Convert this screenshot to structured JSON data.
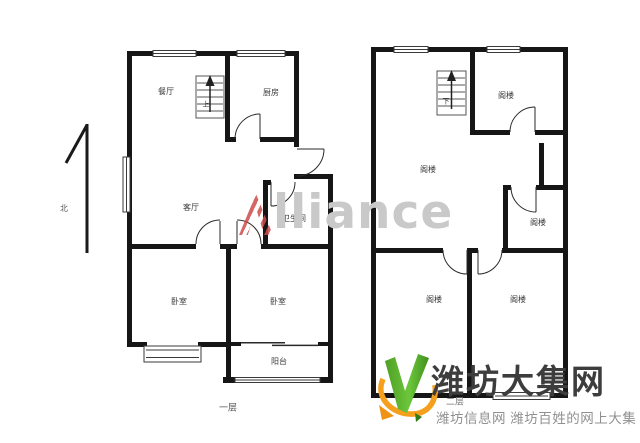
{
  "image": {
    "background": "#ffffff",
    "wall_color": "#161616"
  },
  "watermark": {
    "text": "Alliance",
    "a": "A",
    "rest": "lliance",
    "gray": "#c9c9c9",
    "red": "#cd4b4b"
  },
  "north_arrow": {
    "label": "北"
  },
  "floor1": {
    "label": "一层",
    "stairs": "上",
    "rooms": {
      "dining": "餐厅",
      "kitchen": "厨房",
      "living": "客厅",
      "bathroom": "卫生间",
      "bedroom_left": "卧室",
      "bedroom_right": "卧室",
      "balcony": "阳台"
    }
  },
  "floor2": {
    "label": "二层",
    "stairs": "下",
    "rooms": {
      "top_right": "阁楼",
      "main": "阁楼",
      "mid_right": "阁楼",
      "bottom_left": "阁楼",
      "bottom_right": "阁楼"
    }
  },
  "logo": {
    "title": "潍坊大集网",
    "subtitle": "潍坊信息网 潍坊百姓的网上大集",
    "title_color": "#3d3d3d",
    "subtitle_color": "#909090",
    "green": "#55b42d",
    "orange": "#f5a01d"
  }
}
